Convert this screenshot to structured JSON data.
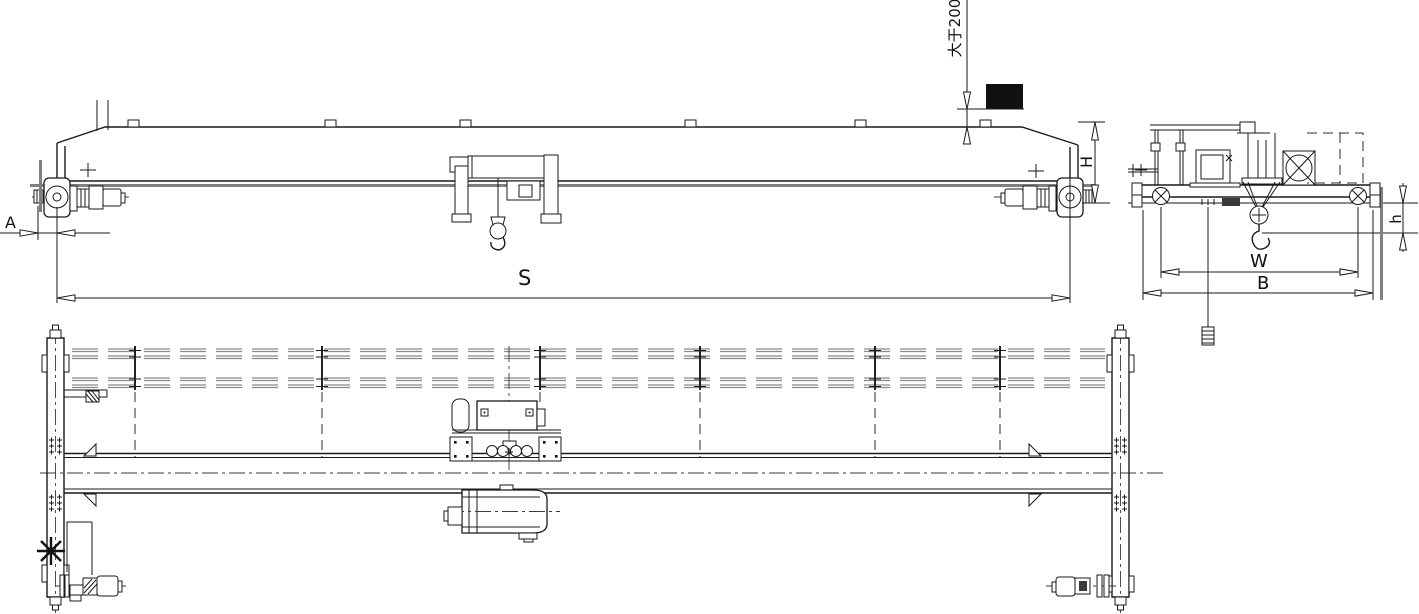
{
  "labels": {
    "span": "S",
    "approach": "A",
    "crane_height": "H",
    "hook_headroom": "h",
    "wheel_base": "W",
    "end_carriage_length": "B",
    "top_clearance_note": "大于200"
  },
  "symbols": {
    "drive_position_marker": "✱"
  },
  "colors": {
    "line": "#1a1a1a",
    "heavy_line": "#808080",
    "obstacle_fill": "#111111",
    "background": "#ffffff"
  }
}
